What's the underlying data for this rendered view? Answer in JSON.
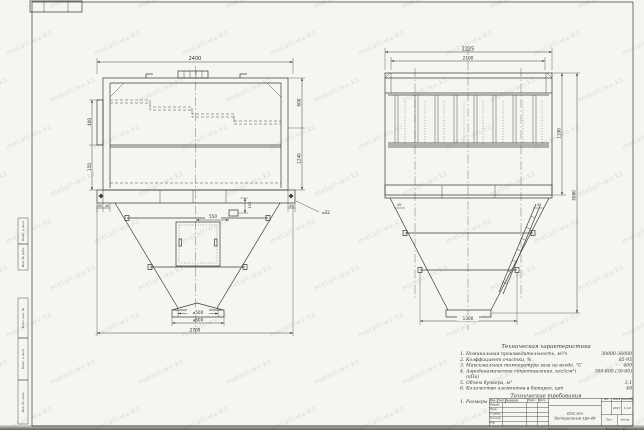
{
  "watermark": {
    "text": "metall-wv.kz"
  },
  "margin_stamps": {
    "group_a": [
      "Подп. и дата",
      "Инв. № дубл."
    ],
    "group_b": [
      "Взам. инв. №",
      "Подп. и дата",
      "Инв. № подл."
    ]
  },
  "front_view": {
    "dims": {
      "top_width": "2400",
      "left_upper": "400",
      "left_lower": "150",
      "base_left_a": "90",
      "base_left_b": "40",
      "right_upper": "600",
      "right_lower": "1240",
      "base_right": "40",
      "bolt_dia": "⌀32",
      "fitting_offset": "550",
      "fitting_height": "105",
      "outlet_dia": "⌀500",
      "flange_dia": "⌀600",
      "base_width": "2700"
    }
  },
  "side_view": {
    "dims": {
      "top_width": "2225",
      "inner_width": "2100",
      "body_height": "1190",
      "total_height": "3080",
      "bottom_width": "1300",
      "slope_left": "45",
      "slope_right": "45"
    }
  },
  "specs": {
    "title": "Техническая характеристика",
    "items": [
      {
        "num": "1.",
        "label": "Номинальная производительность, м³/ч",
        "value": "30000-36000"
      },
      {
        "num": "2.",
        "label": "Коэффициент очистки, %",
        "value": "85-95"
      },
      {
        "num": "3.",
        "label": "Максимальная температура газа на входе, °С",
        "value": "400"
      },
      {
        "num": "4.",
        "label": "Аэродинамическое сопротивление, кгс/(см²)(кПа)",
        "value": "300-600 (30-60)"
      },
      {
        "num": "5.",
        "label": "Объем бункера, м³",
        "value": "3,1"
      },
      {
        "num": "6.",
        "label": "Количество элементов в батарее, шт",
        "value": "48"
      }
    ],
    "requirements_title": "Технические требования",
    "requirements": [
      {
        "num": "1.",
        "text": "Размеры для справок."
      }
    ]
  },
  "title_block": {
    "header_cells": [
      "Изм.",
      "Лист",
      "№ докум.",
      "Подп.",
      "Дата"
    ],
    "row_labels": [
      "Разраб.",
      "Пров.",
      "Т.контр.",
      "Н.контр.",
      "Утв."
    ],
    "title_line1": "Циклон",
    "title_line2": "батарейный ЦБ-48",
    "lit_label": "Лит.",
    "mass_label": "Масса",
    "scale_label": "Масштаб",
    "mass_value": "2017",
    "scale_value": "1:10",
    "sheet_label": "Лист",
    "sheets_label": "Листов",
    "copied_label": "Копировал",
    "format_label": "Формат А1"
  }
}
